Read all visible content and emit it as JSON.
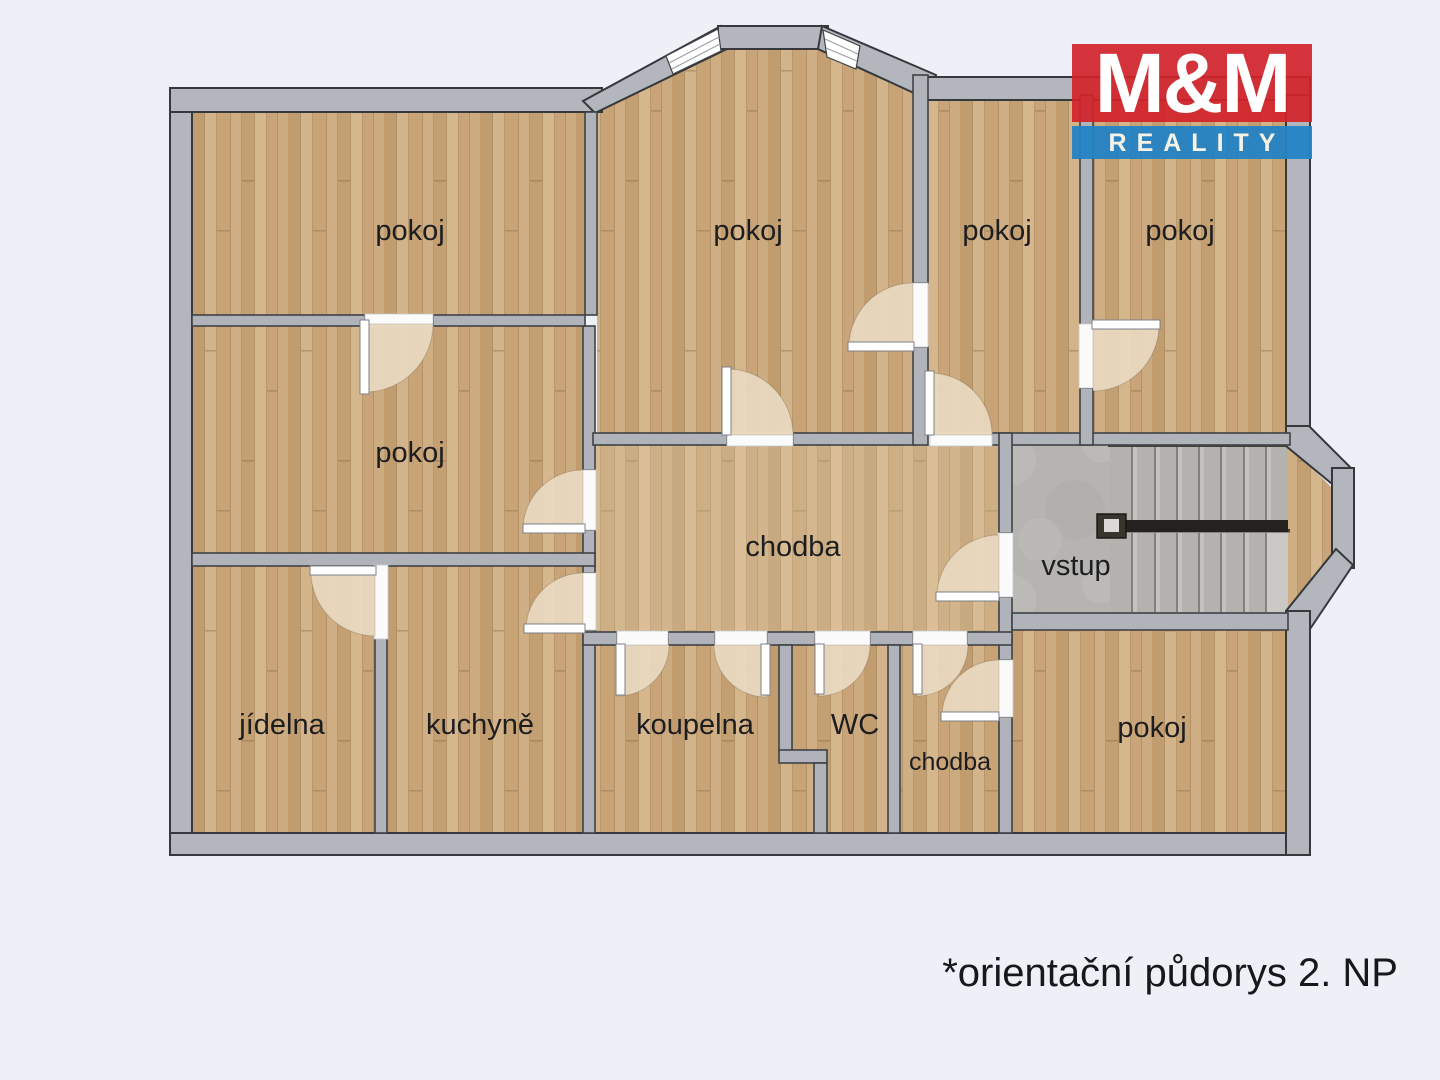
{
  "caption": "*orientační půdorys 2. NP",
  "logo": {
    "top": "M&M",
    "bottom": "REALITY"
  },
  "rooms": {
    "top_left": "pokoj",
    "top_middle": "pokoj",
    "top_right_inner": "pokoj",
    "top_right_outer": "pokoj",
    "mid_left": "pokoj",
    "hallway": "chodba",
    "entry": "vstup",
    "dining": "jídelna",
    "kitchen": "kuchyně",
    "bathroom": "koupelna",
    "wc": "WC",
    "small_hallway": "chodba",
    "bottom_right": "pokoj"
  },
  "colors": {
    "background": "#eef0f8",
    "wall_fill": "#b0b4ba",
    "wall_outline": "#3f4246",
    "wood_floor": "#cbaa7d",
    "concrete_floor": "#b6b4b1",
    "door_swing": "#e9d8bf",
    "logo_red": "#d2232a",
    "logo_blue": "#2383c4",
    "label_text": "#1d1d20"
  }
}
